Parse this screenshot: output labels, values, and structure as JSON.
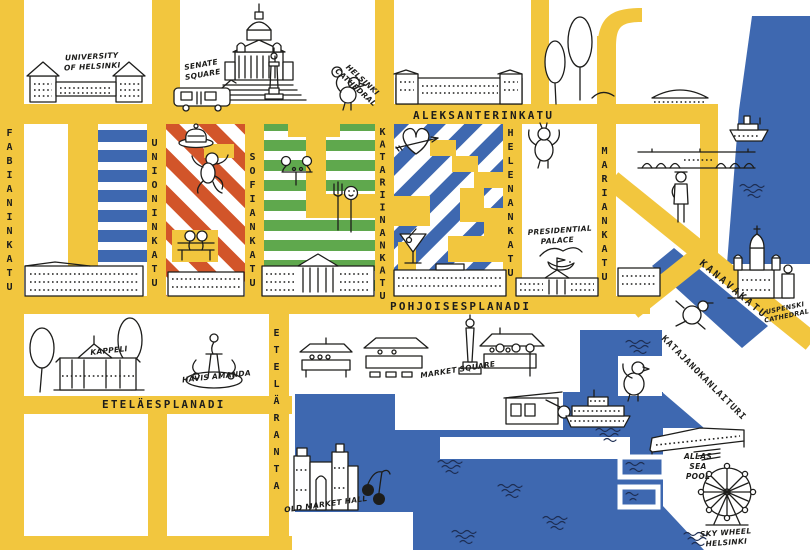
{
  "colors": {
    "street_yellow": "#F2C63E",
    "water_blue": "#3E68B0",
    "stripe_red": "#D2552A",
    "stripe_green": "#5FA84D",
    "stripe_blue": "#3E68B0",
    "ink": "#1d1d1b",
    "wave_navy": "#1d2d52",
    "background": "#ffffff"
  },
  "streets": {
    "aleksanterinkatu": "ALEKSANTERINKATU",
    "pohjoisesplanadi": "POHJOISESPLANADI",
    "etelaesplanadi": "ETELÄESPLANADI",
    "fabianinkatu": "FABIANINKATU",
    "unioninkatu": "UNIONINKATU",
    "sofiankatu": "SOFIANKATU",
    "katariinankatu": "KATARIINANKATU",
    "helenankatu": "HELENANKATU",
    "mariankatu": "MARIANKATU",
    "etelaranta": "ETELÄRANTA",
    "kanavakatu": "KANAVAKATU",
    "katajanokanlaituri": "KATAJANOKANLAITURI"
  },
  "places": {
    "university": "UNIVERSITY OF HELSINKI",
    "senate_square": "SENATE SQUARE",
    "helsinki_cathedral": "HELSINKI CATHEDRAL",
    "presidential_palace": "PRESIDENTIAL PALACE",
    "uspenski_cathedral": "USPENSKI CATHEDRAL",
    "kappeli": "KAPPELI",
    "havis_amanda": "HAVIS AMANDA",
    "market_square": "MARKET SQUARE",
    "old_market_hall": "OLD MARKET HALL",
    "allas_sea_pool": "ALLAS SEA POOL",
    "sky_wheel": "SKY WHEEL HELSINKI"
  },
  "landmark_icons": [
    "university-building-icon",
    "tram-icon",
    "helsinki-cathedral-icon",
    "statue-column-icon",
    "bird-icon",
    "trees-icon",
    "long-building-icon",
    "pavilion-icon",
    "ship-icon",
    "bridge-icon",
    "person-icon",
    "cake-icon",
    "dancing-animal-icon",
    "bench-people-icon",
    "picnic-table-icon",
    "fork-spoon-icon",
    "heart-arrow-icon",
    "cocktail-icon",
    "seagull-icon",
    "palace-icon",
    "city-hall-icon",
    "kappeli-cafe-icon",
    "fountain-icon",
    "market-stall-icon",
    "obelisk-icon",
    "kiosk-icon",
    "ferry-icon",
    "old-market-hall-icon",
    "cherries-icon",
    "uspenski-icon",
    "allas-terrace-icon",
    "ferris-wheel-icon",
    "waves-icon"
  ]
}
